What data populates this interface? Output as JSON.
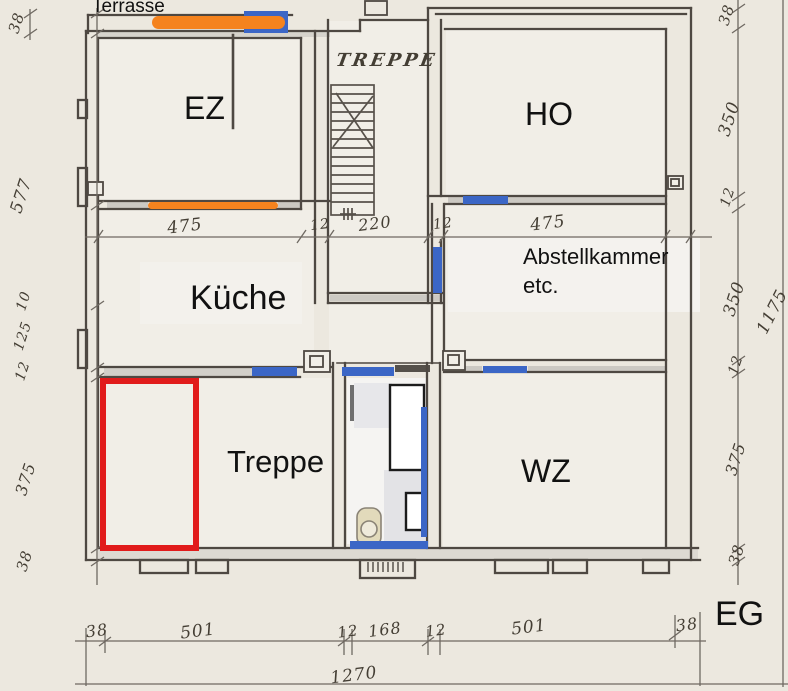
{
  "labels": {
    "terrasse": "Terrasse",
    "treppe_stairs": "TREPPE",
    "ez": "EZ",
    "ho": "HO",
    "kueche": "Küche",
    "abstellkammer_line1": "Abstellkammer",
    "abstellkammer_line2": "etc.",
    "treppe_room": "Treppe",
    "wz": "WZ",
    "eg": "EG"
  },
  "dimensions": {
    "left": {
      "d1": "38",
      "d2": "577",
      "d3": "10",
      "d4": "125",
      "d5": "12",
      "d6": "375",
      "d7": "38"
    },
    "middle": {
      "d1": "475",
      "d2": "12",
      "d3": "220",
      "d4": "12",
      "d5": "475"
    },
    "right": {
      "d1": "38",
      "d2": "350",
      "d3": "12",
      "d4": "350",
      "d5": "12",
      "d6": "375",
      "d7": "38",
      "total": "1175"
    },
    "bottom": {
      "d1": "38",
      "d2": "501",
      "d3": "12",
      "d4": "168",
      "d5": "12",
      "d6": "501",
      "d7": "38",
      "total": "1270"
    }
  },
  "annotation_colors": {
    "orange_highlight": "#f5831e",
    "blue_highlight": "#3b66c6",
    "red_outline": "#e11b1b",
    "pencil": "#4e4842"
  }
}
